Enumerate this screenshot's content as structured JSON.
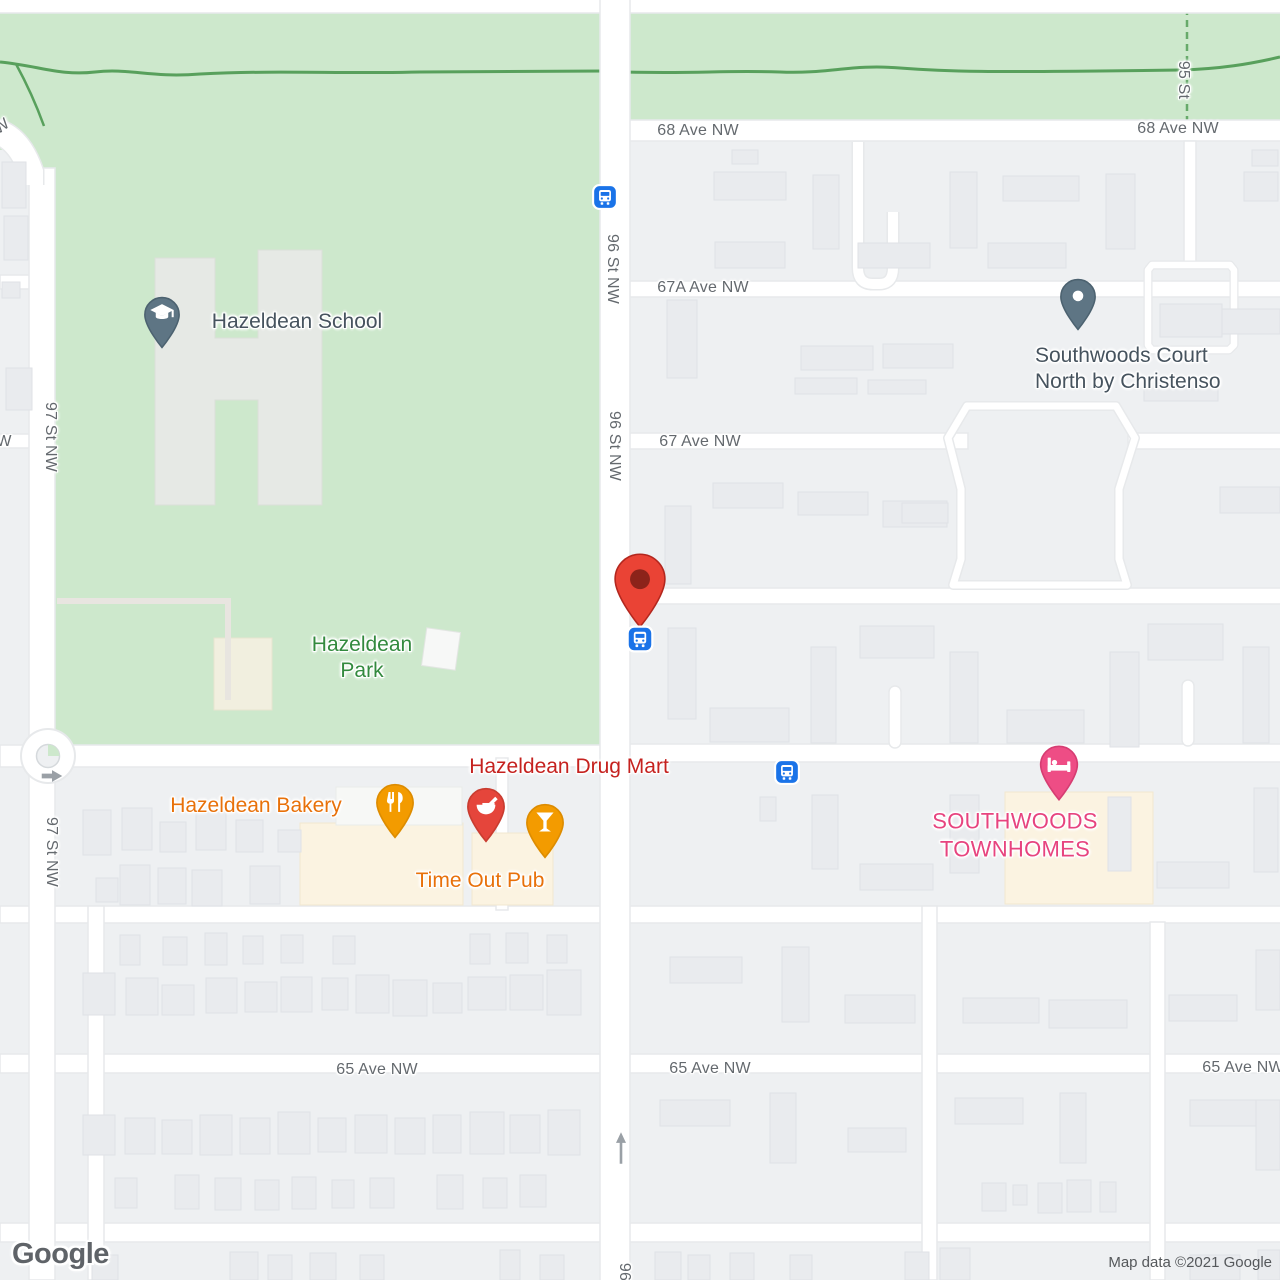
{
  "map": {
    "provider_logo": "Google",
    "attribution": "Map data ©2021 Google",
    "colors": {
      "park_green": "#cde8cc",
      "road_white": "#ffffff",
      "block_gray": "#eef0f2",
      "building_gray": "#e9ebee",
      "commercial_cream": "#fbf3e1",
      "bus_blue": "#1a73e8",
      "destination_red": "#ea4335",
      "pharmacy_red": "#e5453b",
      "food_orange": "#f39b00",
      "lodging_pink": "#ee4d85",
      "school_slate": "#5e7584",
      "street_label_gray": "#64696e",
      "park_label_green": "#338a3e"
    },
    "labels": [
      {
        "name": "street-label-68-ave-nw-left",
        "text": "68 Ave NW",
        "x": 698,
        "y": 131,
        "cls": "st",
        "interactable": false
      },
      {
        "name": "street-label-68-ave-nw-right",
        "text": "68 Ave NW",
        "x": 1178,
        "y": 129,
        "cls": "st",
        "interactable": false
      },
      {
        "name": "street-label-95-st",
        "text": "95 St",
        "x": 1183,
        "y": 80,
        "cls": "st",
        "rotate": 90,
        "interactable": false
      },
      {
        "name": "street-label-96-st-nw-upper",
        "text": "96 St NW",
        "x": 612,
        "y": 269,
        "cls": "st",
        "rotate": 90,
        "interactable": false
      },
      {
        "name": "street-label-96-st-nw-lower",
        "text": "96 St NW",
        "x": 614,
        "y": 446,
        "cls": "st",
        "rotate": 90,
        "interactable": false
      },
      {
        "name": "street-label-97-st-nw-upper",
        "text": "97 St NW",
        "x": 50,
        "y": 437,
        "cls": "st",
        "rotate": 90,
        "interactable": false
      },
      {
        "name": "street-label-97-st-nw-lower",
        "text": "97 St NW",
        "x": 51,
        "y": 852,
        "cls": "st",
        "rotate": 90,
        "interactable": false
      },
      {
        "name": "street-label-67a-ave-nw",
        "text": "67A Ave NW",
        "x": 703,
        "y": 288,
        "cls": "st",
        "interactable": false
      },
      {
        "name": "street-label-67-ave-nw",
        "text": "67 Ave NW",
        "x": 700,
        "y": 442,
        "cls": "st",
        "interactable": false
      },
      {
        "name": "street-label-65-ave-nw-left",
        "text": "65 Ave NW",
        "x": 377,
        "y": 1070,
        "cls": "st",
        "interactable": false
      },
      {
        "name": "street-label-65-ave-nw-mid",
        "text": "65 Ave NW",
        "x": 710,
        "y": 1069,
        "cls": "st",
        "interactable": false
      },
      {
        "name": "street-label-65-ave-nw-right",
        "text": "65 Ave NW",
        "x": 1243,
        "y": 1068,
        "cls": "st",
        "interactable": false
      },
      {
        "name": "street-label-fragment-w-left",
        "text": "W",
        "x": 4,
        "y": 442,
        "cls": "st",
        "interactable": false
      },
      {
        "name": "street-label-fragment-w-topleft",
        "text": "W",
        "x": 2,
        "y": 127,
        "cls": "st",
        "rotate": -35,
        "interactable": false
      },
      {
        "name": "street-label-96-bottom",
        "text": "96",
        "x": 624,
        "y": 1272,
        "cls": "st",
        "rotate": 90,
        "interactable": false
      },
      {
        "name": "poi-label-hazeldean-school",
        "text": "Hazeldean School",
        "x": 297,
        "y": 322,
        "cls": "poi-school",
        "interactable": true
      },
      {
        "name": "poi-label-hazeldean-park",
        "text": "Hazeldean\nPark",
        "x": 362,
        "y": 658,
        "cls": "poi-park",
        "interactable": true
      },
      {
        "name": "poi-label-southwoods-court-north",
        "text": "Southwoods Court\nNorth by Christenso",
        "x": 1035,
        "y": 343,
        "cls": "poi-school",
        "anchor": "lt",
        "interactable": true
      },
      {
        "name": "poi-label-hazeldean-drug-mart",
        "text": "Hazeldean Drug Mart",
        "x": 569,
        "y": 767,
        "cls": "poi-red",
        "interactable": true
      },
      {
        "name": "poi-label-hazeldean-bakery",
        "text": "Hazeldean Bakery",
        "x": 256,
        "y": 806,
        "cls": "poi-orange",
        "interactable": true
      },
      {
        "name": "poi-label-time-out-pub",
        "text": "Time Out Pub",
        "x": 480,
        "y": 881,
        "cls": "poi-orange",
        "interactable": true
      },
      {
        "name": "poi-label-southwoods-townhomes",
        "text": "SOUTHWOODS\nTOWNHOMES",
        "x": 1015,
        "y": 835,
        "cls": "poi-pink",
        "interactable": true
      }
    ],
    "markers": [
      {
        "name": "school-pin-icon",
        "type": "pin",
        "glyph": "school",
        "color": "#5e7584",
        "stroke": "#4c6270",
        "x": 162,
        "y": 349,
        "w": 38,
        "h": 53,
        "anchor": "tip",
        "interactable": true
      },
      {
        "name": "generic-place-pin-icon",
        "type": "pin",
        "glyph": "dot",
        "color": "#5e7584",
        "stroke": "#4c6270",
        "x": 1078,
        "y": 331,
        "w": 38,
        "h": 53,
        "anchor": "tip",
        "interactable": true
      },
      {
        "name": "pharmacy-pin-icon",
        "type": "pin",
        "glyph": "pharmacy",
        "color": "#e5453b",
        "stroke": "#c93c30",
        "x": 486,
        "y": 843,
        "w": 40,
        "h": 56,
        "anchor": "tip",
        "interactable": true
      },
      {
        "name": "restaurant-pin-icon",
        "type": "pin",
        "glyph": "restaurant",
        "color": "#f39b00",
        "stroke": "#dd8c00",
        "x": 395,
        "y": 839,
        "w": 40,
        "h": 56,
        "anchor": "tip",
        "interactable": true
      },
      {
        "name": "bar-pin-icon",
        "type": "pin",
        "glyph": "bar",
        "color": "#f39b00",
        "stroke": "#dd8c00",
        "x": 545,
        "y": 859,
        "w": 40,
        "h": 56,
        "anchor": "tip",
        "interactable": true
      },
      {
        "name": "lodging-pin-icon",
        "type": "pin",
        "glyph": "lodging",
        "color": "#ee4d85",
        "stroke": "#d63d72",
        "x": 1059,
        "y": 802,
        "w": 40,
        "h": 58,
        "anchor": "tip",
        "interactable": true
      },
      {
        "name": "destination-marker-icon",
        "type": "dest",
        "color": "#ea4335",
        "stroke": "#b3271e",
        "x": 640,
        "y": 629,
        "w": 55,
        "h": 77,
        "anchor": "tip",
        "interactable": true
      },
      {
        "name": "bus-stop-icon-96st-north",
        "type": "bus",
        "color": "#1a73e8",
        "x": 605,
        "y": 197,
        "w": 26,
        "h": 26,
        "anchor": "c",
        "interactable": true
      },
      {
        "name": "bus-stop-icon-96st-mid",
        "type": "bus",
        "color": "#1a73e8",
        "x": 640,
        "y": 639,
        "w": 27,
        "h": 27,
        "anchor": "c",
        "interactable": true
      },
      {
        "name": "bus-stop-icon-66ave",
        "type": "bus",
        "color": "#1a73e8",
        "x": 787,
        "y": 772,
        "w": 26,
        "h": 26,
        "anchor": "c",
        "interactable": true
      },
      {
        "name": "roundabout-exit-arrow-icon",
        "type": "arrow-right",
        "x": 52,
        "y": 776,
        "w": 25,
        "h": 14,
        "anchor": "c",
        "interactable": false
      },
      {
        "name": "one-way-north-arrow-icon",
        "type": "arrow-up",
        "x": 621,
        "y": 1148,
        "w": 13,
        "h": 35,
        "anchor": "c",
        "interactable": false
      }
    ]
  }
}
